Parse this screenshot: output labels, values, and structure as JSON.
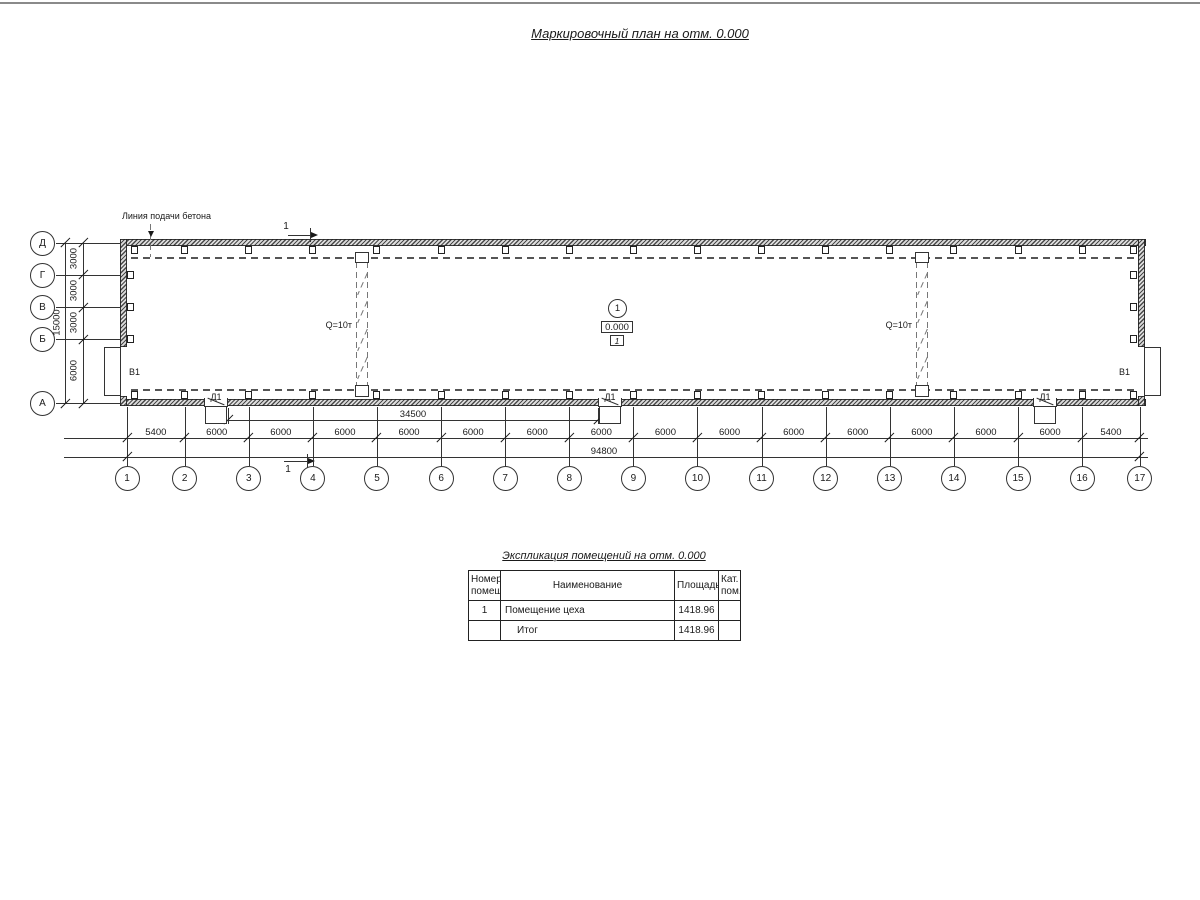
{
  "page": {
    "title": "Маркировочный план на отм. 0.000",
    "frame_color": "#8a8a8a"
  },
  "plan": {
    "labels": {
      "concrete_line": "Линия подачи бетона",
      "crane": "Q=10т",
      "gate": "В1",
      "door": "Д1",
      "section": "1"
    },
    "room_marker": {
      "number": "1",
      "elevation": "0.000",
      "category": "1"
    },
    "axes_bottom": {
      "labels": [
        "1",
        "2",
        "3",
        "4",
        "5",
        "6",
        "7",
        "8",
        "9",
        "10",
        "11",
        "12",
        "13",
        "14",
        "15",
        "16",
        "17"
      ],
      "spans_mm": [
        5400,
        6000,
        6000,
        6000,
        6000,
        6000,
        6000,
        6000,
        6000,
        6000,
        6000,
        6000,
        6000,
        6000,
        6000,
        5400
      ]
    },
    "axes_left": {
      "labels": [
        "Д",
        "Г",
        "В",
        "Б",
        "А"
      ],
      "spans_mm": [
        3000,
        3000,
        3000,
        6000
      ]
    },
    "dims": {
      "total_bottom": "94800",
      "door_span": "34500",
      "total_left": "15000"
    }
  },
  "schedule": {
    "title": "Экспликация помещений на отм. 0.000",
    "columns": [
      "Номер помещ.",
      "Наименование",
      "Площадь",
      "Кат. пом."
    ],
    "rows": [
      [
        "1",
        "Помещение цеха",
        "1418.96",
        ""
      ],
      [
        "",
        "Итог",
        "1418.96",
        ""
      ]
    ]
  }
}
